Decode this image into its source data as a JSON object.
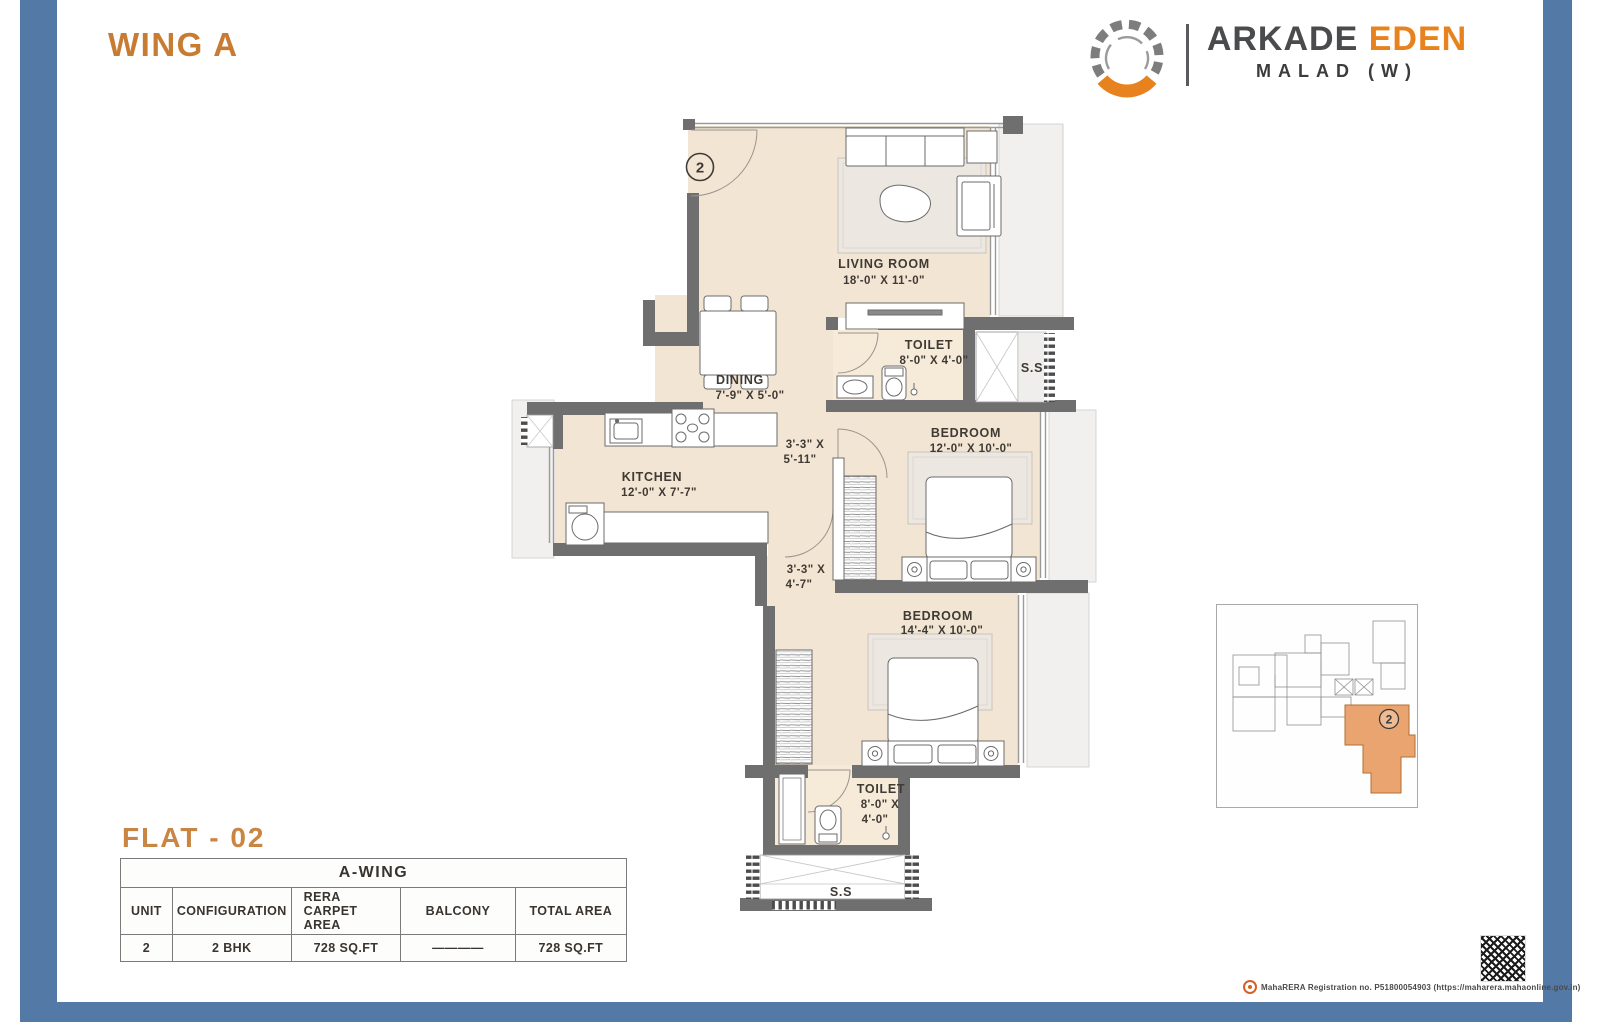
{
  "header": {
    "wing_title": "WING A"
  },
  "brand": {
    "primary": "ARKADE",
    "secondary": "EDEN",
    "location": "MALAD (W)",
    "logo_orange": "#e8821e",
    "logo_gray": "#8a8a8a"
  },
  "plan": {
    "entry_marker": "2",
    "living_room": {
      "name": "LIVING ROOM",
      "dims": "18'-0\" X 11'-0\""
    },
    "dining": {
      "name": "DINING",
      "dims": "7'-9\" X 5'-0\""
    },
    "toilet_top": {
      "name": "TOILET",
      "dims": "8'-0\" X 4'-0\""
    },
    "kitchen": {
      "name": "KITCHEN",
      "dims": "12'-0\" X 7'-7\""
    },
    "bedroom_mid": {
      "name": "BEDROOM",
      "dims": "12'-0\" X 10'-0\""
    },
    "bedroom_bottom": {
      "name": "BEDROOM",
      "dims": "14'-4\" X 10'-0\""
    },
    "toilet_bottom": {
      "name": "TOILET",
      "dims_line1": "8'-0\" X",
      "dims_line2": "4'-0\""
    },
    "passage_upper": {
      "line1": "3'-3\" X",
      "line2": "5'-11\""
    },
    "passage_lower": {
      "line1": "3'-3\" X",
      "line2": "4'-7\""
    },
    "shaft_top": "S.S",
    "shaft_bottom": "S.S"
  },
  "flat": {
    "label": "FLAT - 02"
  },
  "table": {
    "title": "A-WING",
    "columns": [
      "UNIT",
      "CONFIGURATION",
      "RERA CARPET AREA",
      "BALCONY",
      "TOTAL AREA"
    ],
    "row": {
      "unit": "2",
      "configuration": "2 BHK",
      "rera_carpet_area": "728 SQ.FT",
      "balcony": "————",
      "total_area": "728 SQ.FT"
    }
  },
  "keyplan": {
    "marker": "2"
  },
  "footer": {
    "rera_line": "MahaRERA Registration no. P51800054903 (https://maharera.mahaonline.gov.in)"
  },
  "colors": {
    "accent_orange": "#c87c33",
    "frame_blue": "#537aa6",
    "wall_gray": "#6f6f6f",
    "floor_beige": "#f3e5d3",
    "keyplan_unit_orange": "#eaa470"
  }
}
